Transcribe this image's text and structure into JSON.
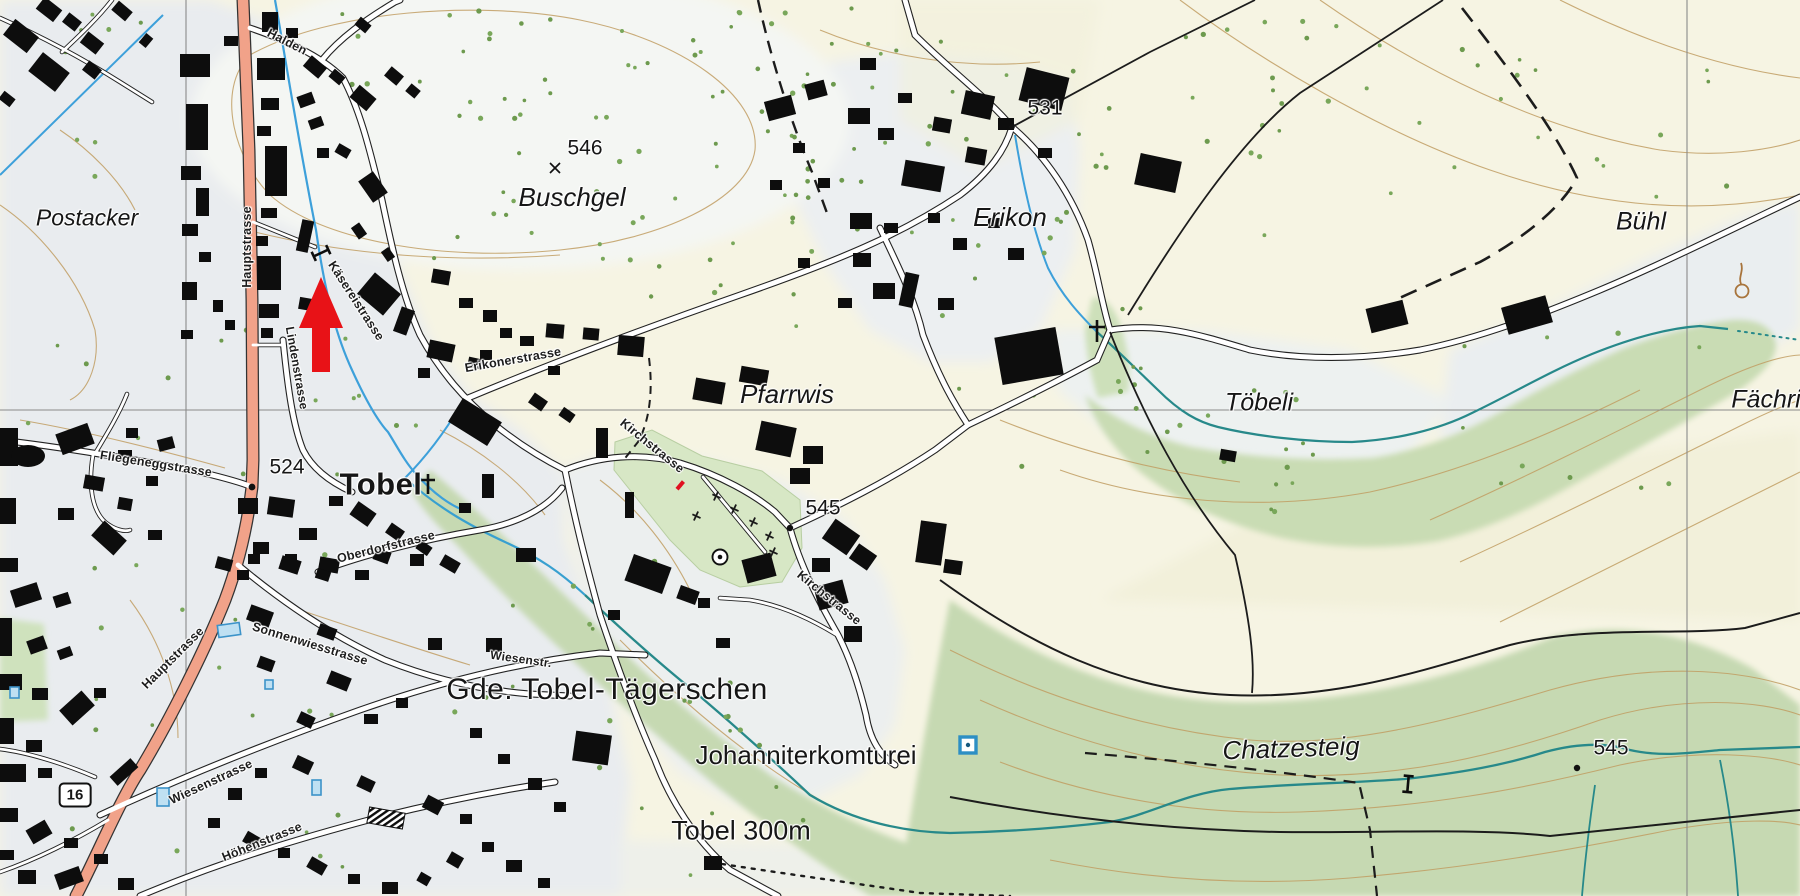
{
  "map": {
    "kind": "topographic-map",
    "style": "swisstopo",
    "marker": {
      "id": "red-arrow",
      "shape": "arrow-up",
      "color": "#e81217",
      "tip_x": 321,
      "tip_y": 277
    },
    "labels": [
      {
        "id": "postacker",
        "text": "Postacker",
        "kind": "area"
      },
      {
        "id": "buschgel",
        "text": "Buschgel",
        "kind": "area"
      },
      {
        "id": "erikon",
        "text": "Erikon",
        "kind": "area"
      },
      {
        "id": "pfarrwis",
        "text": "Pfarrwis",
        "kind": "area"
      },
      {
        "id": "toebeli",
        "text": "Töbeli",
        "kind": "area"
      },
      {
        "id": "buehl",
        "text": "Bühl",
        "kind": "area"
      },
      {
        "id": "faechri",
        "text": "Fächri",
        "kind": "area"
      },
      {
        "id": "chatzesteig",
        "text": "Chatzesteig",
        "kind": "area"
      },
      {
        "id": "tobel",
        "text": "Tobel",
        "kind": "settlement"
      },
      {
        "id": "gde",
        "text": "Gde. Tobel-Tägerschen",
        "kind": "municipality"
      },
      {
        "id": "johanniter",
        "text": "Johanniterkomturei",
        "kind": "poi"
      },
      {
        "id": "tobel300",
        "text": "Tobel 300m",
        "kind": "distance"
      },
      {
        "id": "h546",
        "text": "546",
        "kind": "elevation"
      },
      {
        "id": "h531",
        "text": "531",
        "kind": "elevation"
      },
      {
        "id": "h524",
        "text": "524",
        "kind": "elevation"
      },
      {
        "id": "h545a",
        "text": "545",
        "kind": "elevation"
      },
      {
        "id": "h545b",
        "text": "545",
        "kind": "elevation"
      },
      {
        "id": "hauptstrasse_n",
        "text": "Hauptstrasse",
        "kind": "street"
      },
      {
        "id": "halden",
        "text": "Halden",
        "kind": "street"
      },
      {
        "id": "kaeserei",
        "text": "Käsereistrasse",
        "kind": "street"
      },
      {
        "id": "linden",
        "text": "Lindenstrasse",
        "kind": "street"
      },
      {
        "id": "fliegenegg",
        "text": "Fliegeneggstrasse",
        "kind": "street"
      },
      {
        "id": "erikonerstr",
        "text": "Erikonerstrasse",
        "kind": "street"
      },
      {
        "id": "kirch1",
        "text": "Kirchstrasse",
        "kind": "street"
      },
      {
        "id": "kirch2",
        "text": "Kirchstrasse",
        "kind": "street"
      },
      {
        "id": "oberdorf",
        "text": "Oberdorfstrasse",
        "kind": "street"
      },
      {
        "id": "sonnenwies",
        "text": "Sonnenwiesstrasse",
        "kind": "street"
      },
      {
        "id": "wiesenabbr",
        "text": "Wiesenstr.",
        "kind": "street"
      },
      {
        "id": "wiesen",
        "text": "Wiesenstrasse",
        "kind": "street"
      },
      {
        "id": "hoehen",
        "text": "Höhenstrasse",
        "kind": "street"
      },
      {
        "id": "hauptstrasse_s",
        "text": "Hauptstrasse",
        "kind": "street"
      },
      {
        "id": "shield16",
        "text": "16",
        "kind": "shield"
      }
    ],
    "symbols": [
      {
        "id": "wayside-cross-tobel",
        "icon": "cross-icon",
        "x": 428,
        "y": 483
      },
      {
        "id": "wayside-cross-erikon",
        "icon": "cross-icon",
        "x": 1097,
        "y": 330
      },
      {
        "id": "chapel-circle",
        "icon": "circle-dot-icon",
        "x": 720,
        "y": 557
      },
      {
        "id": "monument-square",
        "icon": "blue-square-icon",
        "x": 968,
        "y": 745
      },
      {
        "id": "spring",
        "icon": "spring-icon",
        "x": 1742,
        "y": 290
      },
      {
        "id": "spot-cross-546",
        "icon": "x-mark-icon",
        "x": 555,
        "y": 168
      },
      {
        "id": "barrier-a",
        "icon": "barrier-icon",
        "x": 320,
        "y": 252
      },
      {
        "id": "barrier-b",
        "icon": "barrier-icon",
        "x": 1408,
        "y": 784
      }
    ],
    "colors": {
      "settlement_bg": "#e8ebef",
      "field_bg": "#f6f4e3",
      "vegetation": "#c6d9b2",
      "cemetery": "#d7e7c5",
      "contour": "#c19e63",
      "stream_blue": "#3da0da",
      "stream_teal": "#27898a",
      "main_road": "#f1a289",
      "tree_dot": "#79a75a",
      "building": "#0d0d0d",
      "grid": "#8a8a8a"
    }
  }
}
